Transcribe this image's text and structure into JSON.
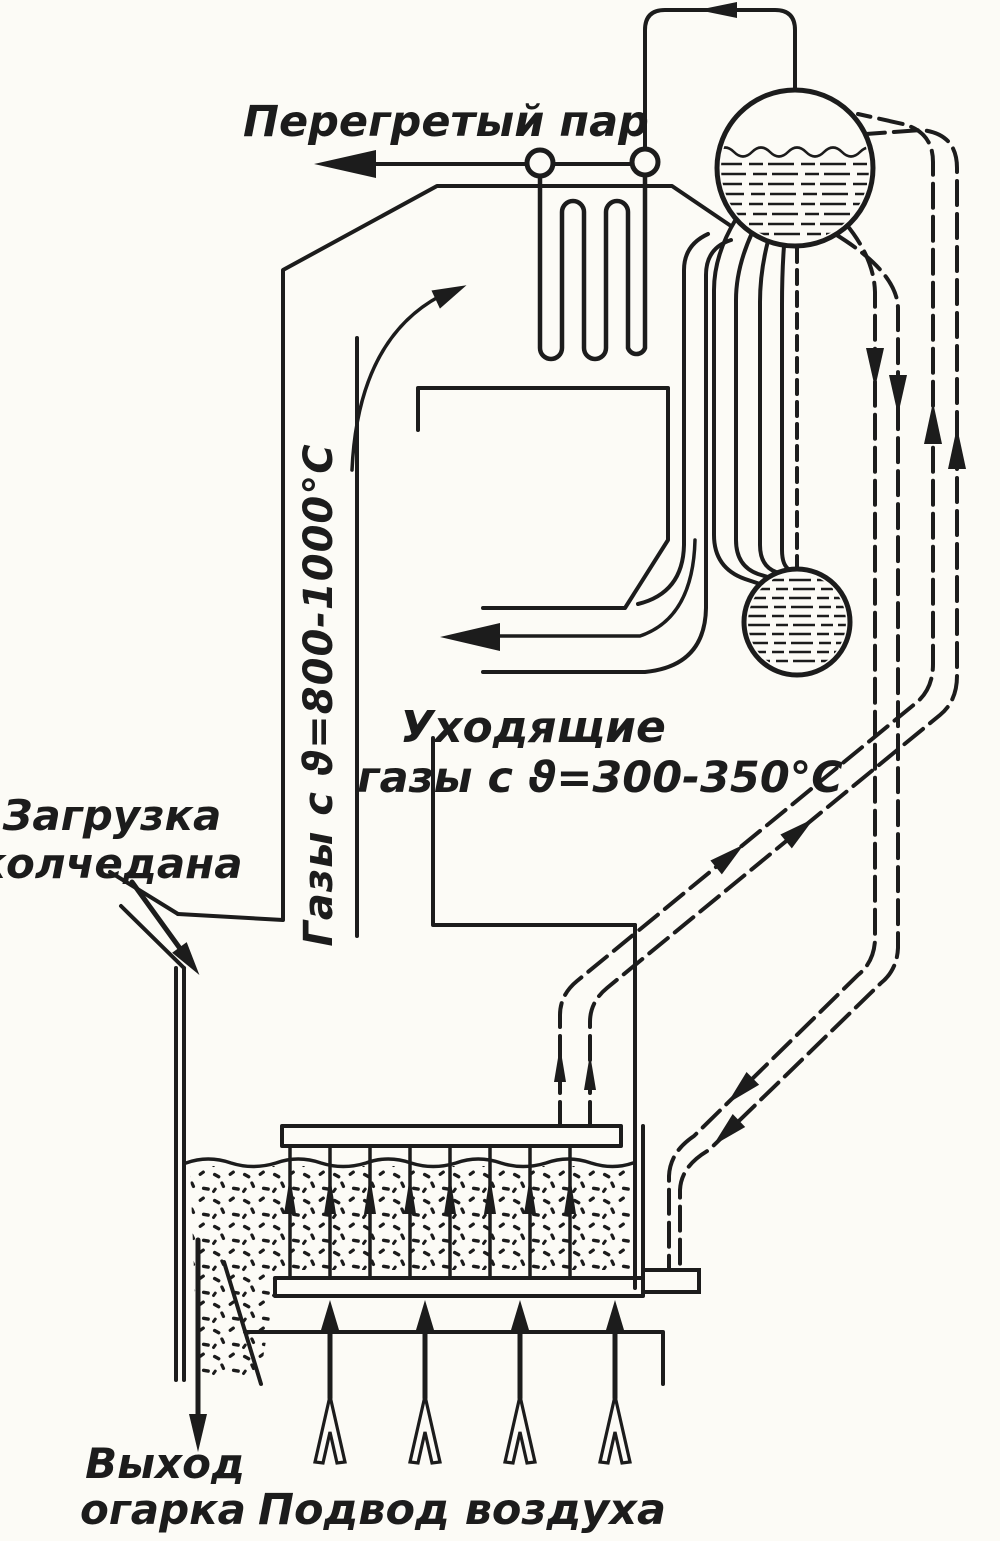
{
  "diagram": {
    "type": "technical-schematic",
    "subject": "fluidized-bed pyrite roasting furnace with waste-heat boiler",
    "labels": {
      "superheated_steam": "Перегретый пар",
      "hot_gases_vertical": "Газы с ϑ=800-1000°С",
      "exhaust_gases": [
        "Уходящие",
        "газы с ϑ=300-350°С"
      ],
      "pyrite_loading": [
        "Загрузка",
        "колчедана"
      ],
      "cinder_output": [
        "Выход",
        "огарка"
      ],
      "air_supply": "Подвод воздуха"
    },
    "temperatures": {
      "furnace_gases_c": "800-1000",
      "exhaust_gases_c": "300-350"
    },
    "components": [
      "steam-drum",
      "lower-drum",
      "superheater-coil",
      "downcomer-pipes",
      "riser-pipes",
      "boiler-tube-bundle",
      "fluidized-bed",
      "in-bed-cooling-tubes",
      "grate",
      "air-box",
      "pyrite-chute",
      "cinder-hopper",
      "exhaust-duct"
    ],
    "colors": {
      "ink": "#1c1c1c",
      "paper": "#fcfbf6"
    }
  }
}
